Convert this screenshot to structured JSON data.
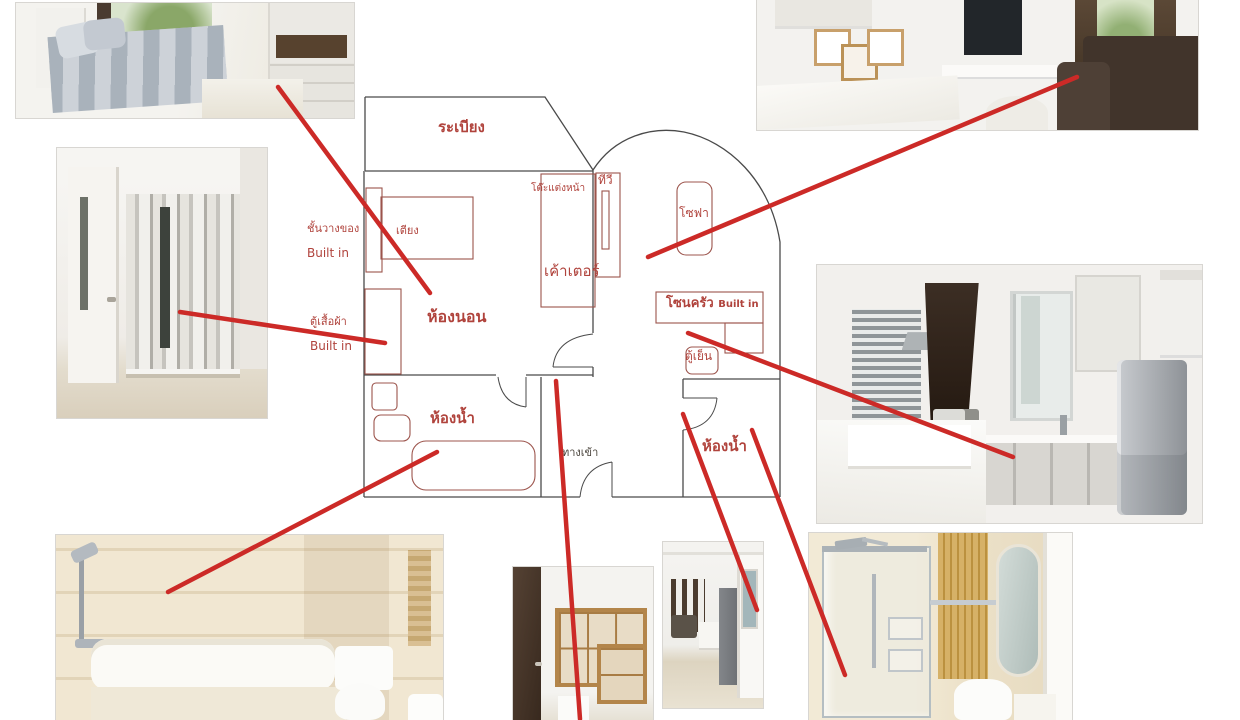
{
  "title": "Condo unit floor plan with room photos",
  "colors": {
    "wall": "#4a4a4a",
    "furniture": "#9c544c",
    "label": "#b0433c",
    "line": "#cc2a27",
    "entrance_label": "#4a443c"
  },
  "floorplan": {
    "labels": {
      "balcony": "ระเบียง",
      "bed": "เตียง",
      "shelf_line1": "ชั้นวางของ",
      "shelf_line2": "Built in",
      "wardrobe_line1": "ตู้เสื้อผ้า",
      "wardrobe_line2": "Built in",
      "bedroom": "ห้องนอน",
      "dressing_table": "โต๊ะแต่งหน้า",
      "counter": "เค้าเตอร์",
      "tv": "ทีวี",
      "sofa": "โซฟา",
      "kitchen_zone": "โซนครัว",
      "kitchen_zone_suffix": "Built in",
      "fridge": "ตู้เย็น",
      "bathroom_left": "ห้องน้ำ",
      "entrance": "ทางเข้า",
      "bathroom_right": "ห้องน้ำ"
    }
  },
  "photos": [
    {
      "id": "bedroom",
      "name": "bedroom-photo"
    },
    {
      "id": "hallway",
      "name": "hallway-wardrobe-photo"
    },
    {
      "id": "living",
      "name": "living-room-photo"
    },
    {
      "id": "kitchen",
      "name": "kitchen-photo"
    },
    {
      "id": "bathtub",
      "name": "bathtub-bathroom-photo"
    },
    {
      "id": "entry",
      "name": "entry-shelves-photo"
    },
    {
      "id": "hallview",
      "name": "hall-view-photo"
    },
    {
      "id": "shower",
      "name": "shower-bathroom-photo"
    }
  ],
  "annotations": {
    "lines": [
      {
        "x1": 278,
        "y1": 87,
        "x2": 430,
        "y2": 293,
        "from": "bedroom-photo",
        "to": "bedroom-plan"
      },
      {
        "x1": 180,
        "y1": 312,
        "x2": 385,
        "y2": 343,
        "from": "hallway-photo",
        "to": "wardrobe-plan"
      },
      {
        "x1": 1077,
        "y1": 77,
        "x2": 648,
        "y2": 257,
        "from": "living-room-photo",
        "to": "sofa-plan"
      },
      {
        "x1": 688,
        "y1": 333,
        "x2": 1013,
        "y2": 457,
        "from": "kitchen-zone-plan",
        "to": "kitchen-photo"
      },
      {
        "x1": 437,
        "y1": 452,
        "x2": 168,
        "y2": 592,
        "from": "bathtub-plan",
        "to": "bathtub-photo"
      },
      {
        "x1": 556,
        "y1": 381,
        "x2": 580,
        "y2": 719,
        "from": "entrance-plan",
        "to": "entry-photo"
      },
      {
        "x1": 683,
        "y1": 414,
        "x2": 757,
        "y2": 610,
        "from": "bathroom-right-door-plan",
        "to": "hall-view-photo"
      },
      {
        "x1": 752,
        "y1": 430,
        "x2": 845,
        "y2": 675,
        "from": "bathroom-right-plan",
        "to": "shower-photo"
      }
    ]
  }
}
